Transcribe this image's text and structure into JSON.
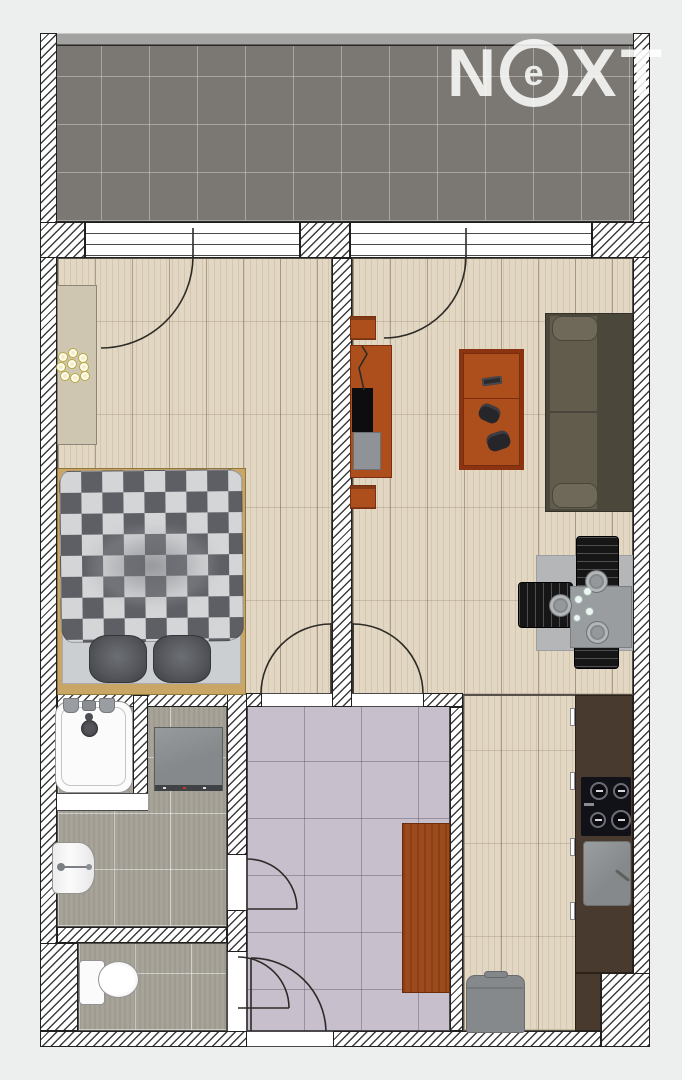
{
  "watermark": {
    "letters": [
      "N",
      "e",
      "X",
      "T"
    ]
  },
  "rooms": [
    "balcony",
    "bedroom",
    "living-room",
    "kitchen",
    "hallway",
    "bathroom",
    "wc"
  ],
  "furniture": [
    "double-bed",
    "dresser",
    "flowers",
    "tv-cabinet",
    "tv",
    "speakers",
    "coffee-table",
    "remote-control",
    "gamepads",
    "sofa",
    "dining-table",
    "dining-chairs",
    "plates",
    "kitchen-counter",
    "cooktop",
    "kitchen-sink",
    "trash-bin",
    "wardrobe",
    "shower-tray",
    "washing-machine",
    "bathroom-sink",
    "toilet"
  ],
  "palette": {
    "background": "#edefee",
    "wall-hatch": "#3d3d3d",
    "wall-outline": "#1f1f1f",
    "railing": "#a2a2a0",
    "wood-floor": "#e2d7c3",
    "balcony-tile": "#7b7772",
    "balcony-grout": "rgba(205,203,199,0.55)",
    "gray-tile": "#a7a399",
    "purple-tile-light": "#c8bfcd",
    "furniture-wood": "#ad4f1d",
    "furniture-wood-dark": "#7c2f0e",
    "counter-dark": "#483a2f",
    "sofa-frame": "#4b473a",
    "sofa-seat": "#615c4b",
    "sofa-armrest": "#6e6959",
    "duvet-dark": "#5d5f65",
    "duvet-light": "#d4d5d7",
    "pillow": "#55575c",
    "bed-frame": "#c9a566",
    "mattress": "#cbcfd2",
    "appliance-gray": "#85898b",
    "fixture-white": "#fbfbfb",
    "fixture-edge": "#939393",
    "chair-black": "#161616",
    "table-gray": "#9a9da0",
    "rug-gray": "#b4b6b8",
    "dresser": "#cfc6b2",
    "wardrobe-wood": "#9c491b",
    "logo-white": "rgba(255,255,255,0.85)"
  }
}
